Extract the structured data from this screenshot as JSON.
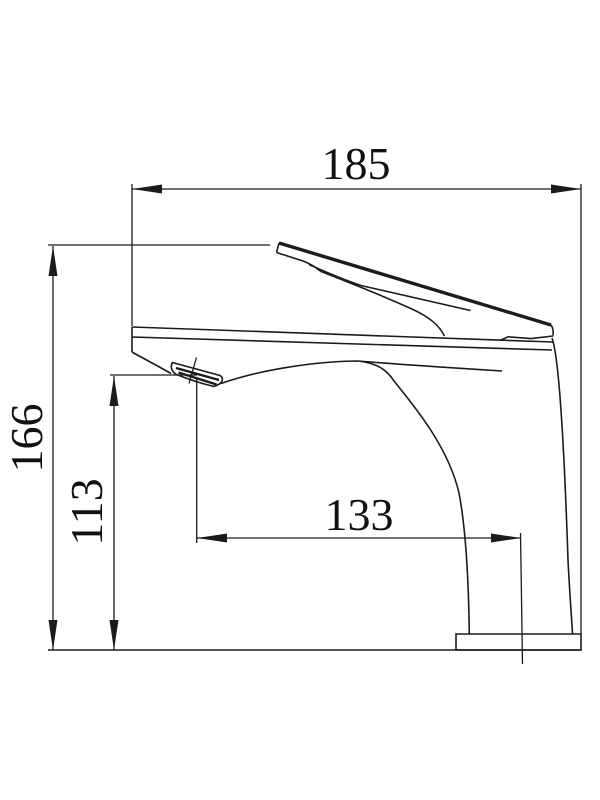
{
  "drawing": {
    "type": "technical-dimension-drawing",
    "subject": "basin faucet side view",
    "colors": {
      "line": "#1b1b1b",
      "background": "#ffffff"
    },
    "dimensions": {
      "overall_length": "185",
      "overall_height": "166",
      "outlet_height": "113",
      "spout_reach": "133"
    }
  }
}
